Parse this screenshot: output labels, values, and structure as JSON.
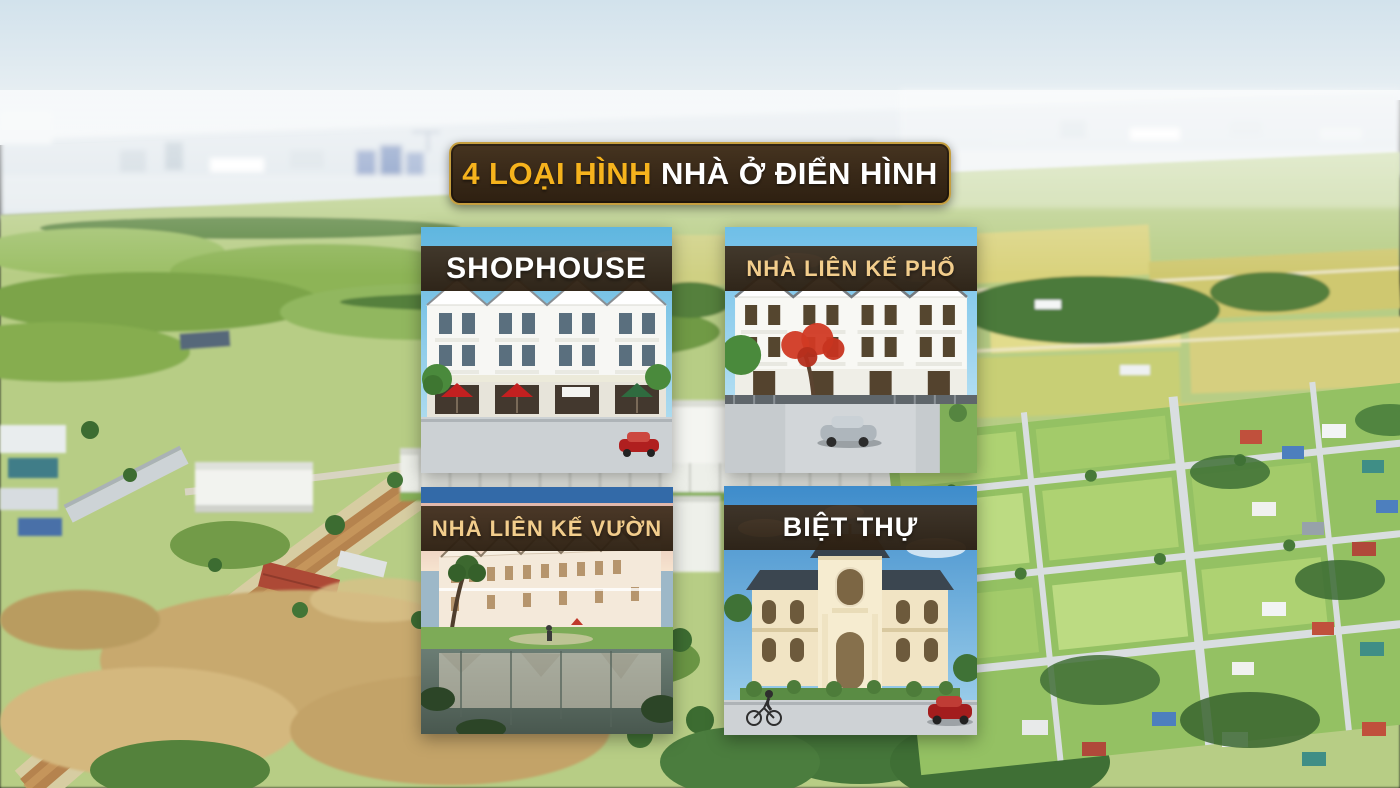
{
  "title_banner": {
    "highlight": "4 LOẠI HÌNH",
    "rest": "NHÀ Ở ĐIỂN HÌNH",
    "background_color": "#3a2a19",
    "border_color": "#c59e3f",
    "highlight_color": "#f6b31d",
    "rest_color": "#ffffff"
  },
  "cards": [
    {
      "key": "shophouse",
      "label": "SHOPHOUSE",
      "label_color": "#ffffff"
    },
    {
      "key": "nha-lien-ke-pho",
      "label": "NHÀ LIÊN KẾ PHỐ",
      "label_color": "#f2cd8c"
    },
    {
      "key": "nha-lien-ke-vuon",
      "label": "NHÀ LIÊN KẾ VƯỜN",
      "label_color": "#f2cd8c"
    },
    {
      "key": "biet-thu",
      "label": "BIỆT THỰ",
      "label_color": "#ffffff"
    }
  ],
  "card_header_color": "rgba(54,39,24,0.93)"
}
